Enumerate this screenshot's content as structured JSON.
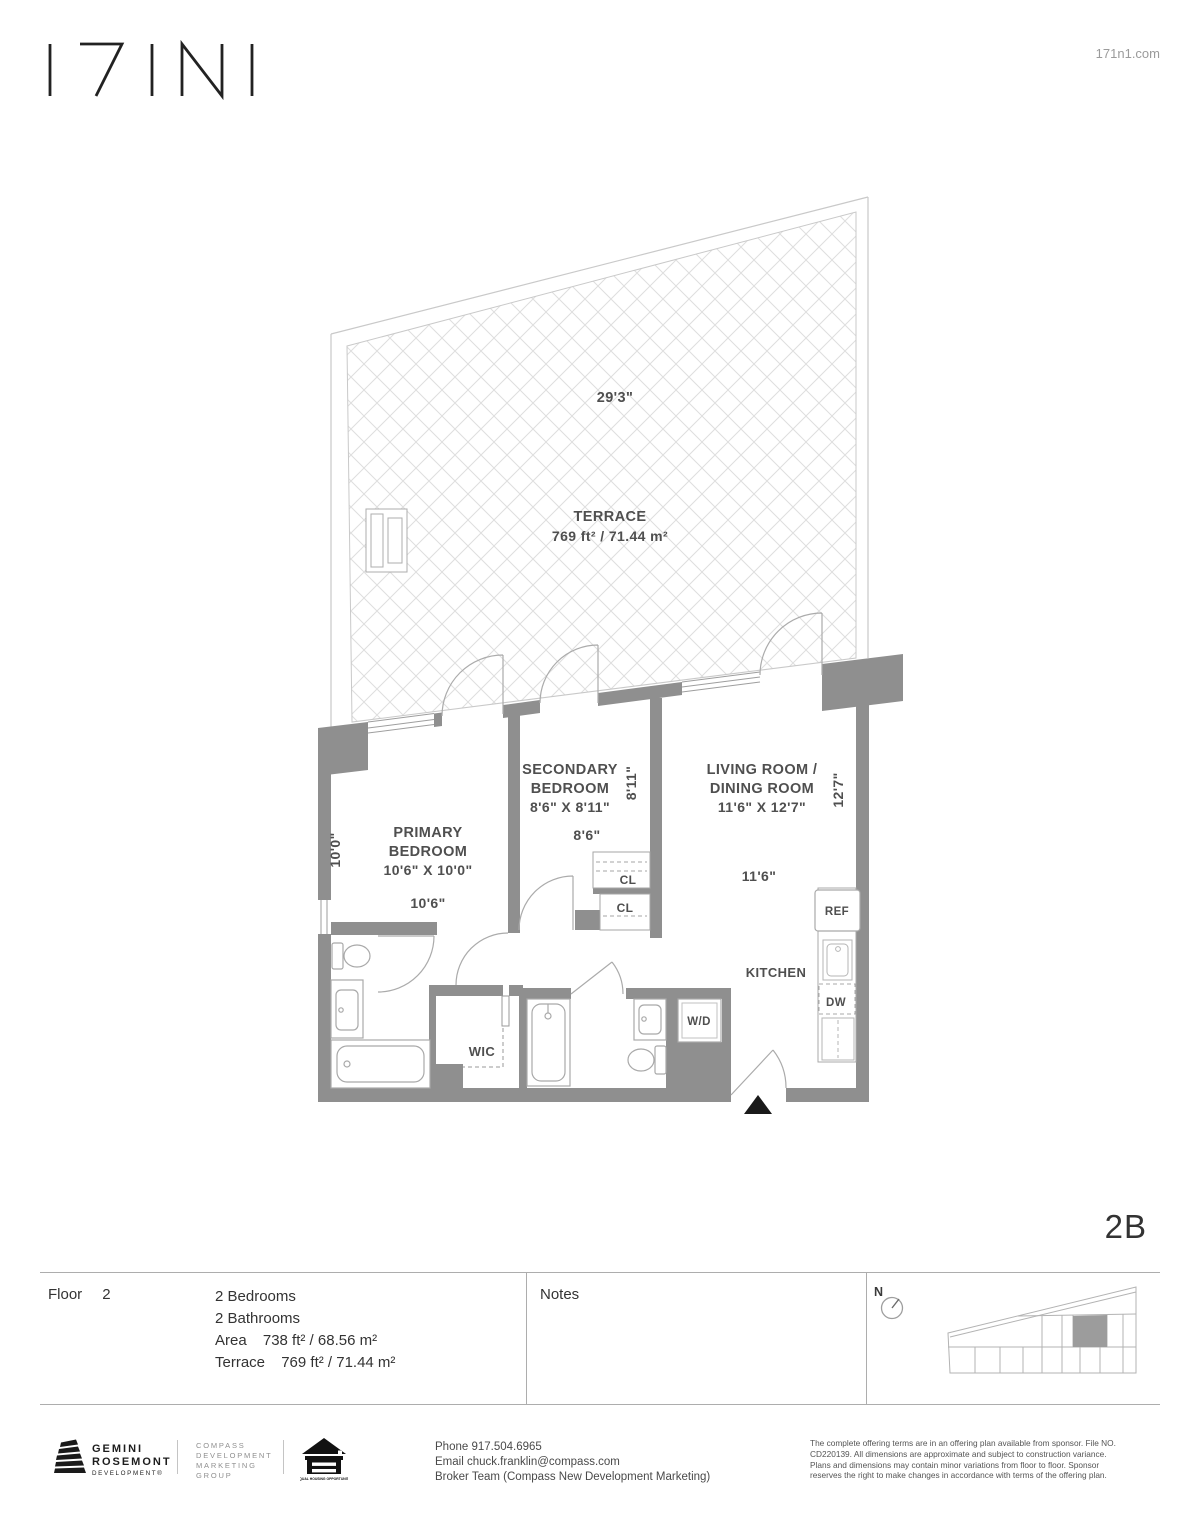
{
  "header": {
    "logo_text": "171N1",
    "website": "171n1.com"
  },
  "unit_label": "2B",
  "colors": {
    "wall": "#8f8f8f",
    "hatch": "#dedede",
    "railing": "#c9c9c9",
    "plan_text": "#4f4f4f",
    "highlight_unit": "#9c9c9c"
  },
  "plan": {
    "terrace": {
      "dim_width": "29'3\"",
      "name": "TERRACE",
      "area": "769 ft² / 71.44 m²"
    },
    "primary": {
      "line1": "PRIMARY",
      "line2": "BEDROOM",
      "dims": "10'6\" X 10'0\"",
      "dim_w": "10'6\"",
      "dim_h": "10'0\""
    },
    "secondary": {
      "line1": "SECONDARY",
      "line2": "BEDROOM",
      "dims": "8'6\" X 8'11\"",
      "dim_w": "8'6\"",
      "dim_h": "8'11\""
    },
    "living": {
      "line1": "LIVING ROOM /",
      "line2": "DINING ROOM",
      "dims": "11'6\" X 12'7\"",
      "dim_w": "11'6\"",
      "dim_h": "12'7\""
    },
    "kitchen": "KITCHEN",
    "wic": "WIC",
    "wd": "W/D",
    "ref": "REF",
    "dw": "DW",
    "cl_upper": "CL",
    "cl_lower": "CL"
  },
  "info_band": {
    "floor_label": "Floor",
    "floor_value": "2",
    "bedrooms": "2 Bedrooms",
    "bathrooms": "2 Bathrooms",
    "area_label": "Area",
    "area_value": "738 ft² / 68.56 m²",
    "terrace_label": "Terrace",
    "terrace_value": "769 ft² / 71.44 m²",
    "notes_label": "Notes",
    "north_label": "N"
  },
  "footer": {
    "gemini": {
      "line1": "GEMINI",
      "line2": "ROSEMONT",
      "sub": "DEVELOPMENT®"
    },
    "compass": {
      "line1": "COMPASS",
      "line2": "DEVELOPMENT",
      "line3": "MARKETING",
      "line4": "GROUP"
    },
    "equal_housing": "EQUAL HOUSING OPPORTUNITY",
    "contact": {
      "phone": "Phone 917.504.6965",
      "email": "Email chuck.franklin@compass.com",
      "broker": "Broker Team (Compass New Development Marketing)"
    },
    "legal": {
      "line1": "The complete offering terms are in an offering plan available from sponsor. File NO.",
      "line2": "CD220139. All dimensions are approximate and subject to construction variance.",
      "line3": "Plans and dimensions may contain minor variations from floor to floor. Sponsor",
      "line4": "reserves the right to make changes in accordance with terms of the offering plan."
    }
  }
}
